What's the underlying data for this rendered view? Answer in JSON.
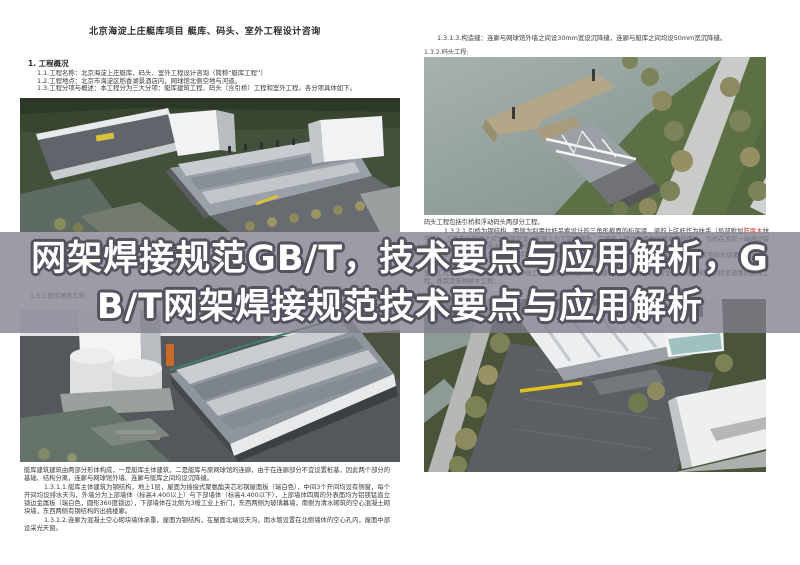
{
  "banner": {
    "line1": "网架焊接规范GB/T，技术要点与应用解析，G",
    "line2": "B/T网架焊接规范技术要点与应用解析",
    "bg_color": "#807f8d",
    "text_color": "#ffffff",
    "outline_color": "#53525e"
  },
  "left_page": {
    "title": "北京海淀上庄艇库项目 艇库、码头、室外工程设计咨询",
    "section_heading": "1.  工程概况",
    "intro_lines": [
      "1.1.工程名称：北京海淀上庄艇库、码头、室外工程设计咨询（简称“艇库工程”）",
      "1.2.工程地点：北京市海淀区稻香湖景酒店内，网球馆北侧空地与河道。",
      "1.3.工程分项与概述：本工程分为三大分项：艇库建筑工程、码头（含引桥）工程和室外工程。各分项具体如下。"
    ],
    "label_building": "1.3.1.艇库建筑工程:",
    "para_overview": "艇库建筑建筑由两部分形体构成，一是艇库主体建筑，二是艇库与原网球馆的连廊，由于在连廊部分不宜设置桩基，因此两个部分的基础、结构分离，连廊与网球馆外墙、连廊与艇库之间均设沉降缝。",
    "para_main_building": "1.3.1.1.艇库主体建筑为钢结构，地上1层，屋面为插接式聚氨酯夹芯彩钢屋面板（瑞白色），中间3个开间均设有侧窗，每个开间均设排水天沟，外墙分为上部墙体（标高4.400以上）与下部墙体（标高4.400以下），上部墙体四周的外表面均为铝镁锰直立锁边金属板（瑞白色，圆形360度锁边），下部墙体在北侧为3樘工业上折门，东西两侧为玻璃幕墙，南侧为清水砌筑的空心混凝土砌块墙，东西两侧有钢结构的出挑楼廊。",
    "para_corridor": "1.3.1.2.连廊为混凝土空心砌块墙体承重，屋面为钢结构，在屋面北端设天沟，雨水管设置在北侧墙体的空心孔内，屋面中部设采光天窗。"
  },
  "right_page": {
    "line_joint": "1.3.1.3.构造缝：连廊与网球馆外墙之间设30mm宽设沉降缝，连廊与艇库之间均设50mm宽沉降缝。",
    "label_dock": "1.3.2.码头工程:",
    "para_dock_overview": "码头工程包括引桥和浮动码头两部分工程。",
    "para_bridge_pre": "1.3.2.1.引桥为钢结构，两侧为利用拉杆吊索设计的三角形截面的桁架梁，梁的上弦杆作为扶手（局部附加",
    "para_bridge_red": "防腐木",
    "para_bridge_post": "扶手板），三角形桁架梁之间为桁架支梁，支梁上为方钢管横条，在横条上铺设浅褐色的塑格栅桥面板，引桥在河岸一端通过铰接支座，固定在钢筋混凝土肋墙上伸出的混凝土牛腿上梁顶。",
    "para_float": "1.3.2.2.浮动码头为钢结构浮箱式码头，面层为塑木铺装，引桥活动端搁置于码头面层上（引桥至码头设聚苯层）。",
    "label_outdoor": "1.3.3.室外工程:",
    "para_outdoor": "室外工程包括：给排水及强弱电的外线工程，艇库及周边场地的铺装工程（包括其中的室外管线），码头引桥至道路的自流工程，移栽及新种树木工程。"
  }
}
